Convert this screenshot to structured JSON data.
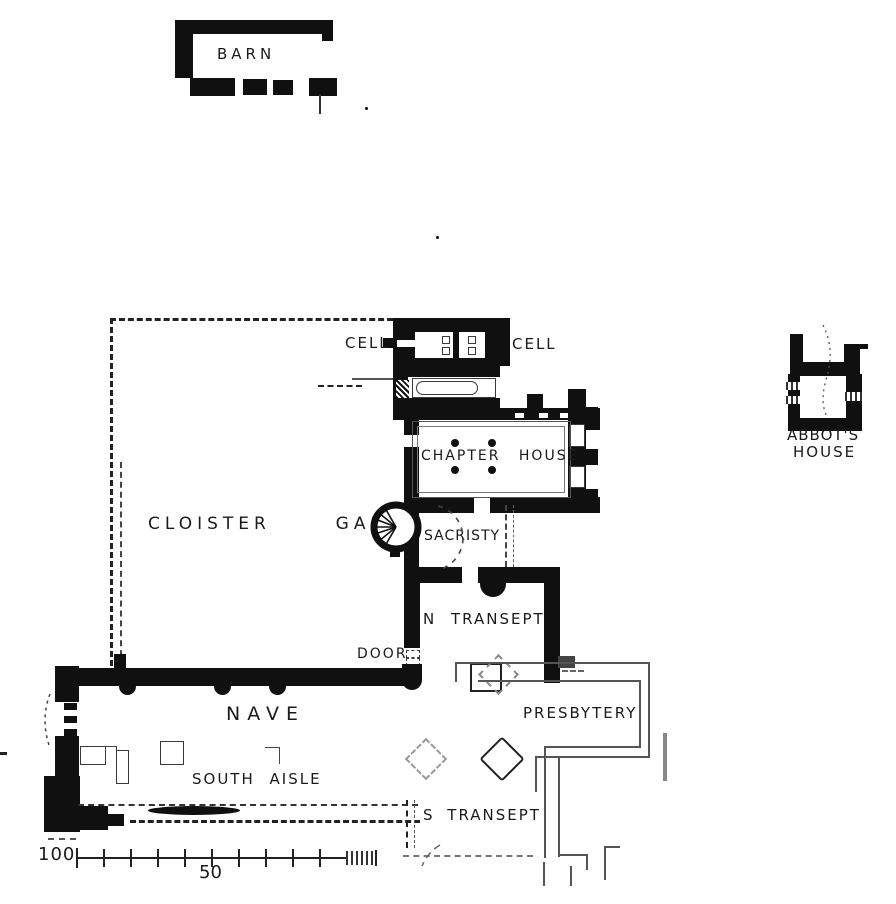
{
  "title": "Abbey ground plan (scanned ink drawing)",
  "labels": {
    "barn": "BARN",
    "cell_left": "CELL",
    "cell_right": "CELL",
    "chapter_house": "CHAPTER HOUSE",
    "cloister_garth": "CLOISTER  GARTH",
    "sacristy": "SACRISTY",
    "abbots_house_line1": "ABBOT'S",
    "abbots_house_line2": "HOUSE",
    "n_transept": "N TRANSEPT",
    "door": "DOOR",
    "nave": "NAVE",
    "presbytery": "PRESBYTERY",
    "south_aisle": "SOUTH AISLE",
    "s_transept": "S TRANSEPT"
  },
  "scale_bar": {
    "start_label": "100",
    "mid_label": "50"
  },
  "colors": {
    "ink": "#101010",
    "paper": "#ffffff",
    "faint_line": "#555555"
  }
}
